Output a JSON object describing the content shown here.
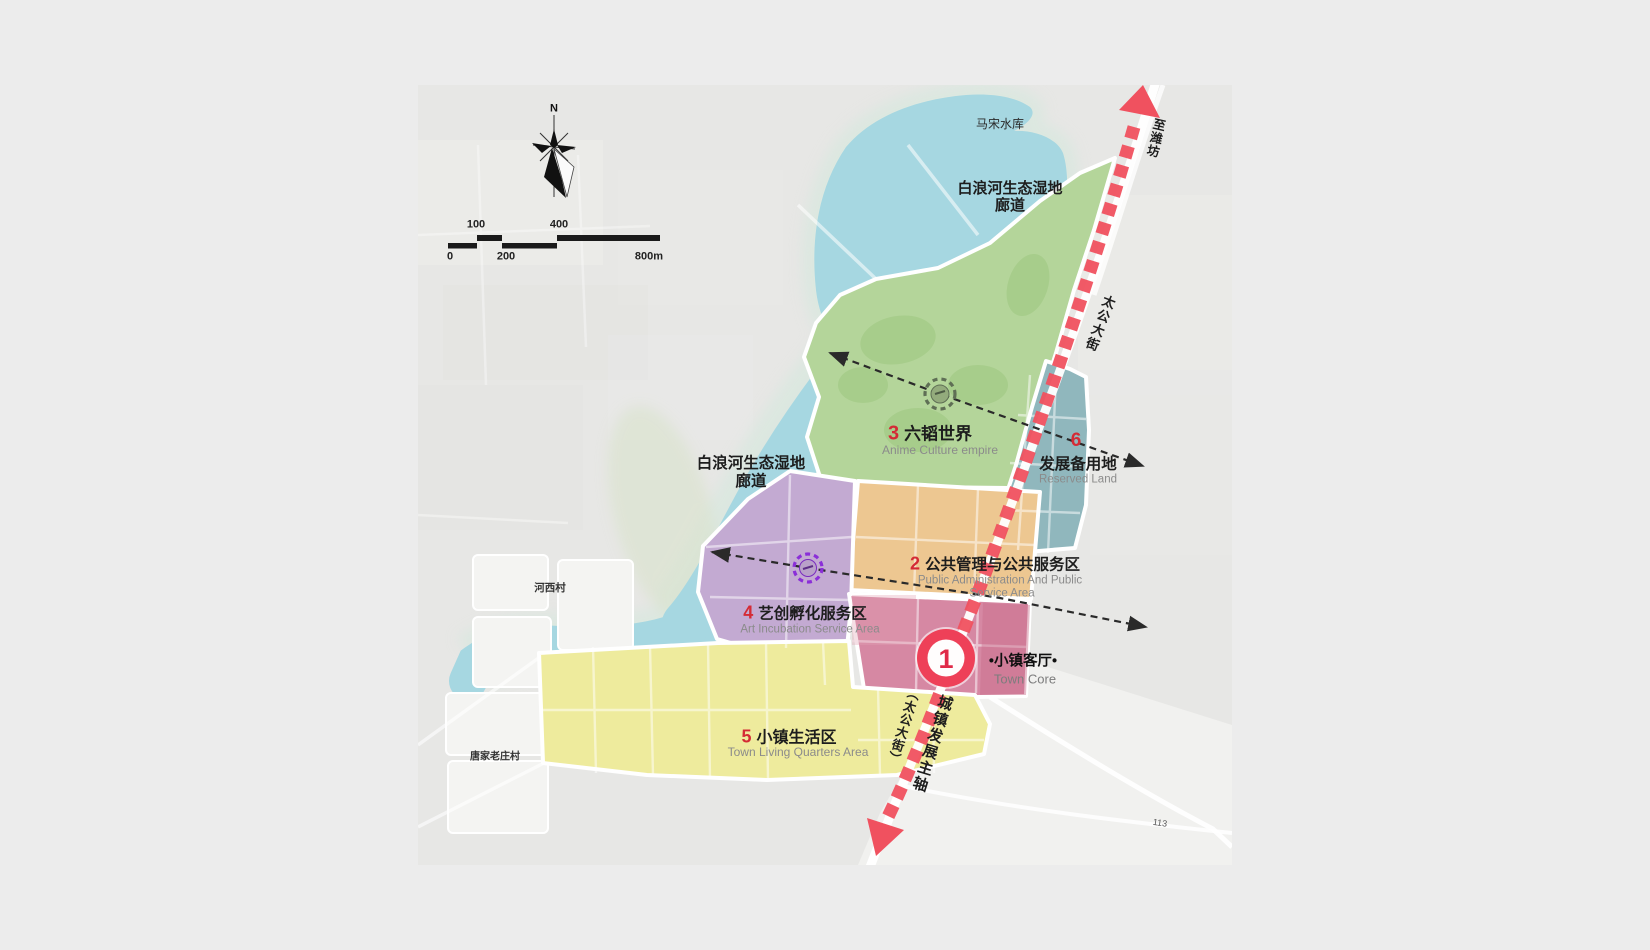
{
  "map": {
    "compass_north": "N",
    "scale_bar": {
      "label_100": "100",
      "label_400": "400",
      "label_0": "0",
      "label_200": "200",
      "label_800m": "800m"
    },
    "place_labels": {
      "reservoir": "马宋水库",
      "wetland_corridor_upper": {
        "line1": "白浪河生态湿地",
        "line2": "廊道"
      },
      "wetland_corridor_left": {
        "line1": "白浪河生态湿地",
        "line2": "廊道"
      },
      "to_weifang": "至潍坊",
      "taigong_street": "太公大街",
      "axis_title": "城镇发展主轴",
      "axis_subtitle": "（太公大街）",
      "village_hexi": "河西村",
      "village_tangjialaozhuang": "唐家老庄村",
      "road_number": "113"
    },
    "zones": [
      {
        "number": "1",
        "name_zh": "•小镇客厅•",
        "name_en": "Town Core",
        "color": "#d688a3"
      },
      {
        "number": "2",
        "name_zh": "公共管理与公共服务区",
        "name_en_line1": "Public Administration And Public",
        "name_en_line2": "Service Area",
        "color": "#edc791"
      },
      {
        "number": "3",
        "name_zh": "六韬世界",
        "name_en": "Anime Culture empire",
        "color": "#b4d59a"
      },
      {
        "number": "4",
        "name_zh": "艺创孵化服务区",
        "name_en": "Art Incubation Service Area",
        "color": "#c3aad2"
      },
      {
        "number": "5",
        "name_zh": "小镇生活区",
        "name_en": "Town Living Quarters Area",
        "color": "#eeeb9d"
      },
      {
        "number": "6",
        "name_zh": "发展备用地",
        "name_en": "Reserved Land",
        "color": "#90b7bd"
      }
    ],
    "colors": {
      "background": "#ececec",
      "map_base": "#e7e7e5",
      "water": "#a6d7e1",
      "water_halo": "#dce7e0",
      "wetland_green": "#d8e3cc",
      "axis_red": "#f0515f",
      "number_red": "#d42b35",
      "road_white": "#ffffff",
      "marker_green": "#5f6f55",
      "marker_green_fill": "#93ab7c",
      "marker_purple": "#8b2fd8",
      "marker_purple_fill": "#b9a1c9",
      "dashed_arrow_black": "#2a2a2a"
    }
  }
}
